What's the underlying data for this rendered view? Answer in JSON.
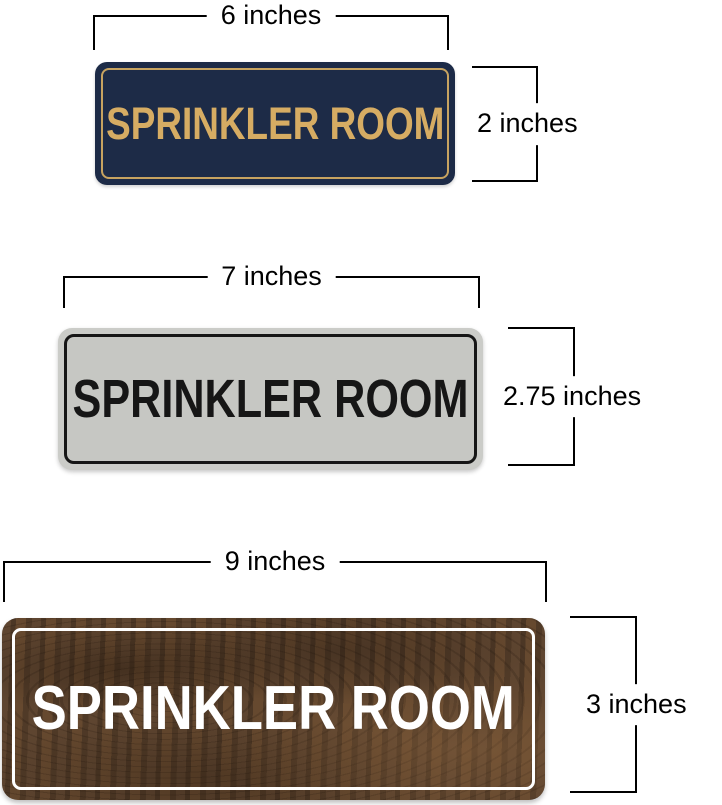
{
  "page": {
    "background_color": "#ffffff",
    "dimension_line_color": "#000000",
    "dimension_text_color": "#000000"
  },
  "signs": [
    {
      "variant": "navy-gold",
      "text": "SPRINKLER ROOM",
      "width_label": "6 inches",
      "height_label": "2 inches",
      "colors": {
        "background": "#1d2b47",
        "border": "#c7a360",
        "text": "#d6ac63"
      }
    },
    {
      "variant": "silver-black",
      "text": "SPRINKLER ROOM",
      "width_label": "7 inches",
      "height_label": "2.75 inches",
      "colors": {
        "background": "#c6c7c3",
        "border": "#161616",
        "text": "#161616"
      }
    },
    {
      "variant": "walnut-wood",
      "text": "SPRINKLER ROOM",
      "width_label": "9 inches",
      "height_label": "3 inches",
      "colors": {
        "background": "#55402c",
        "border": "#ffffff",
        "text": "#ffffff"
      }
    }
  ]
}
